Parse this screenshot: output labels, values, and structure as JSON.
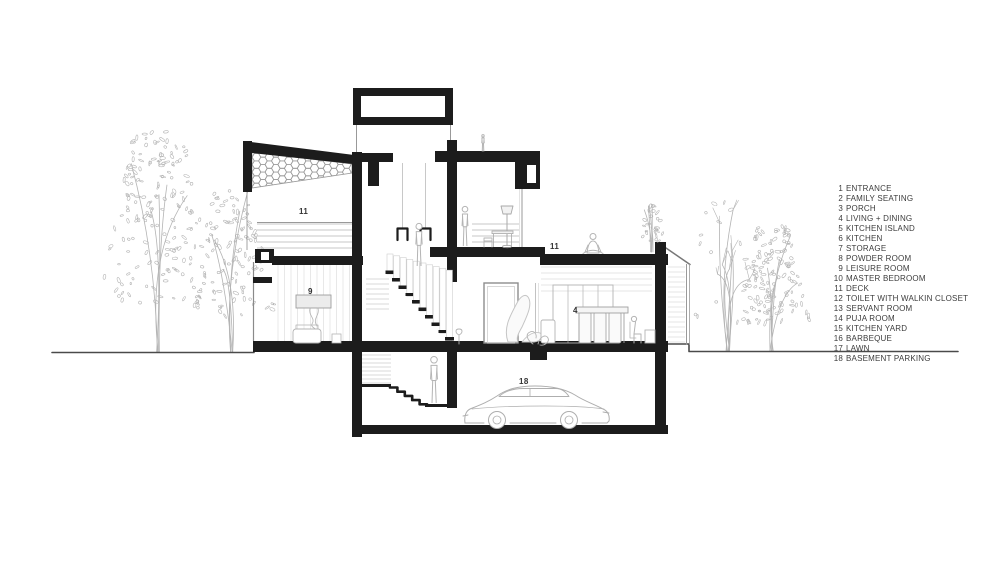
{
  "legend": {
    "items": [
      {
        "n": "1",
        "label": "ENTRANCE"
      },
      {
        "n": "2",
        "label": "FAMILY SEATING"
      },
      {
        "n": "3",
        "label": "PORCH"
      },
      {
        "n": "4",
        "label": "LIVING + DINING"
      },
      {
        "n": "5",
        "label": "KITCHEN ISLAND"
      },
      {
        "n": "6",
        "label": "KITCHEN"
      },
      {
        "n": "7",
        "label": "STORAGE"
      },
      {
        "n": "8",
        "label": "POWDER ROOM"
      },
      {
        "n": "9",
        "label": "LEISURE ROOM"
      },
      {
        "n": "10",
        "label": "MASTER BEDROOM"
      },
      {
        "n": "11",
        "label": "DECK"
      },
      {
        "n": "12",
        "label": "TOILET WITH WALKIN CLOSET"
      },
      {
        "n": "13",
        "label": "SERVANT ROOM"
      },
      {
        "n": "14",
        "label": "PUJA ROOM"
      },
      {
        "n": "15",
        "label": "KITCHEN YARD"
      },
      {
        "n": "16",
        "label": "BARBEQUE"
      },
      {
        "n": "17",
        "label": "LAWN"
      },
      {
        "n": "18",
        "label": "BASEMENT PARKING"
      }
    ]
  },
  "annotations": {
    "deck_left": "11",
    "leisure_room": "9",
    "deck_right": "11",
    "living_dining": "4",
    "basement_parking": "18"
  },
  "colors": {
    "ink": "#1c1c1c",
    "sketch": "#b4b4b4",
    "texture": "#dedede",
    "mid": "#999999",
    "ground": "#4a4a4a",
    "label": "#333333"
  }
}
